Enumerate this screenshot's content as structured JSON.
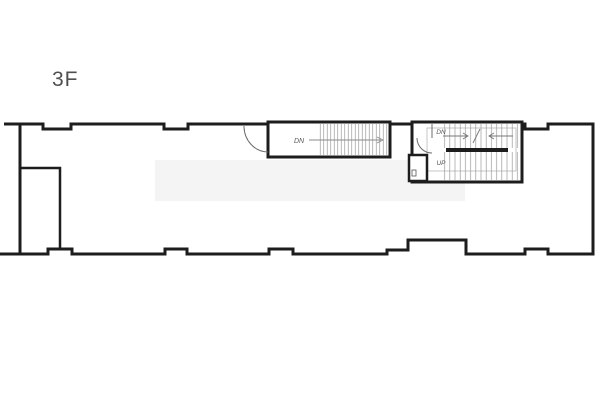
{
  "window": {
    "background": "#ffffff"
  },
  "floor_plan": {
    "title": "3F",
    "labels": {
      "middle_stair_dn": "DN",
      "right_stair_dn": "DN",
      "right_stair_up": "UP"
    },
    "colors": {
      "wall": "#1d1d1d",
      "tread_line": "#9a9a9a",
      "guide_line": "#b8b8b8",
      "annotation": "#6b6b6b",
      "title_text": "#4f4f4f",
      "stair_label_text": "#555555",
      "watermark": "#f4f4f4",
      "background": "#ffffff"
    }
  }
}
